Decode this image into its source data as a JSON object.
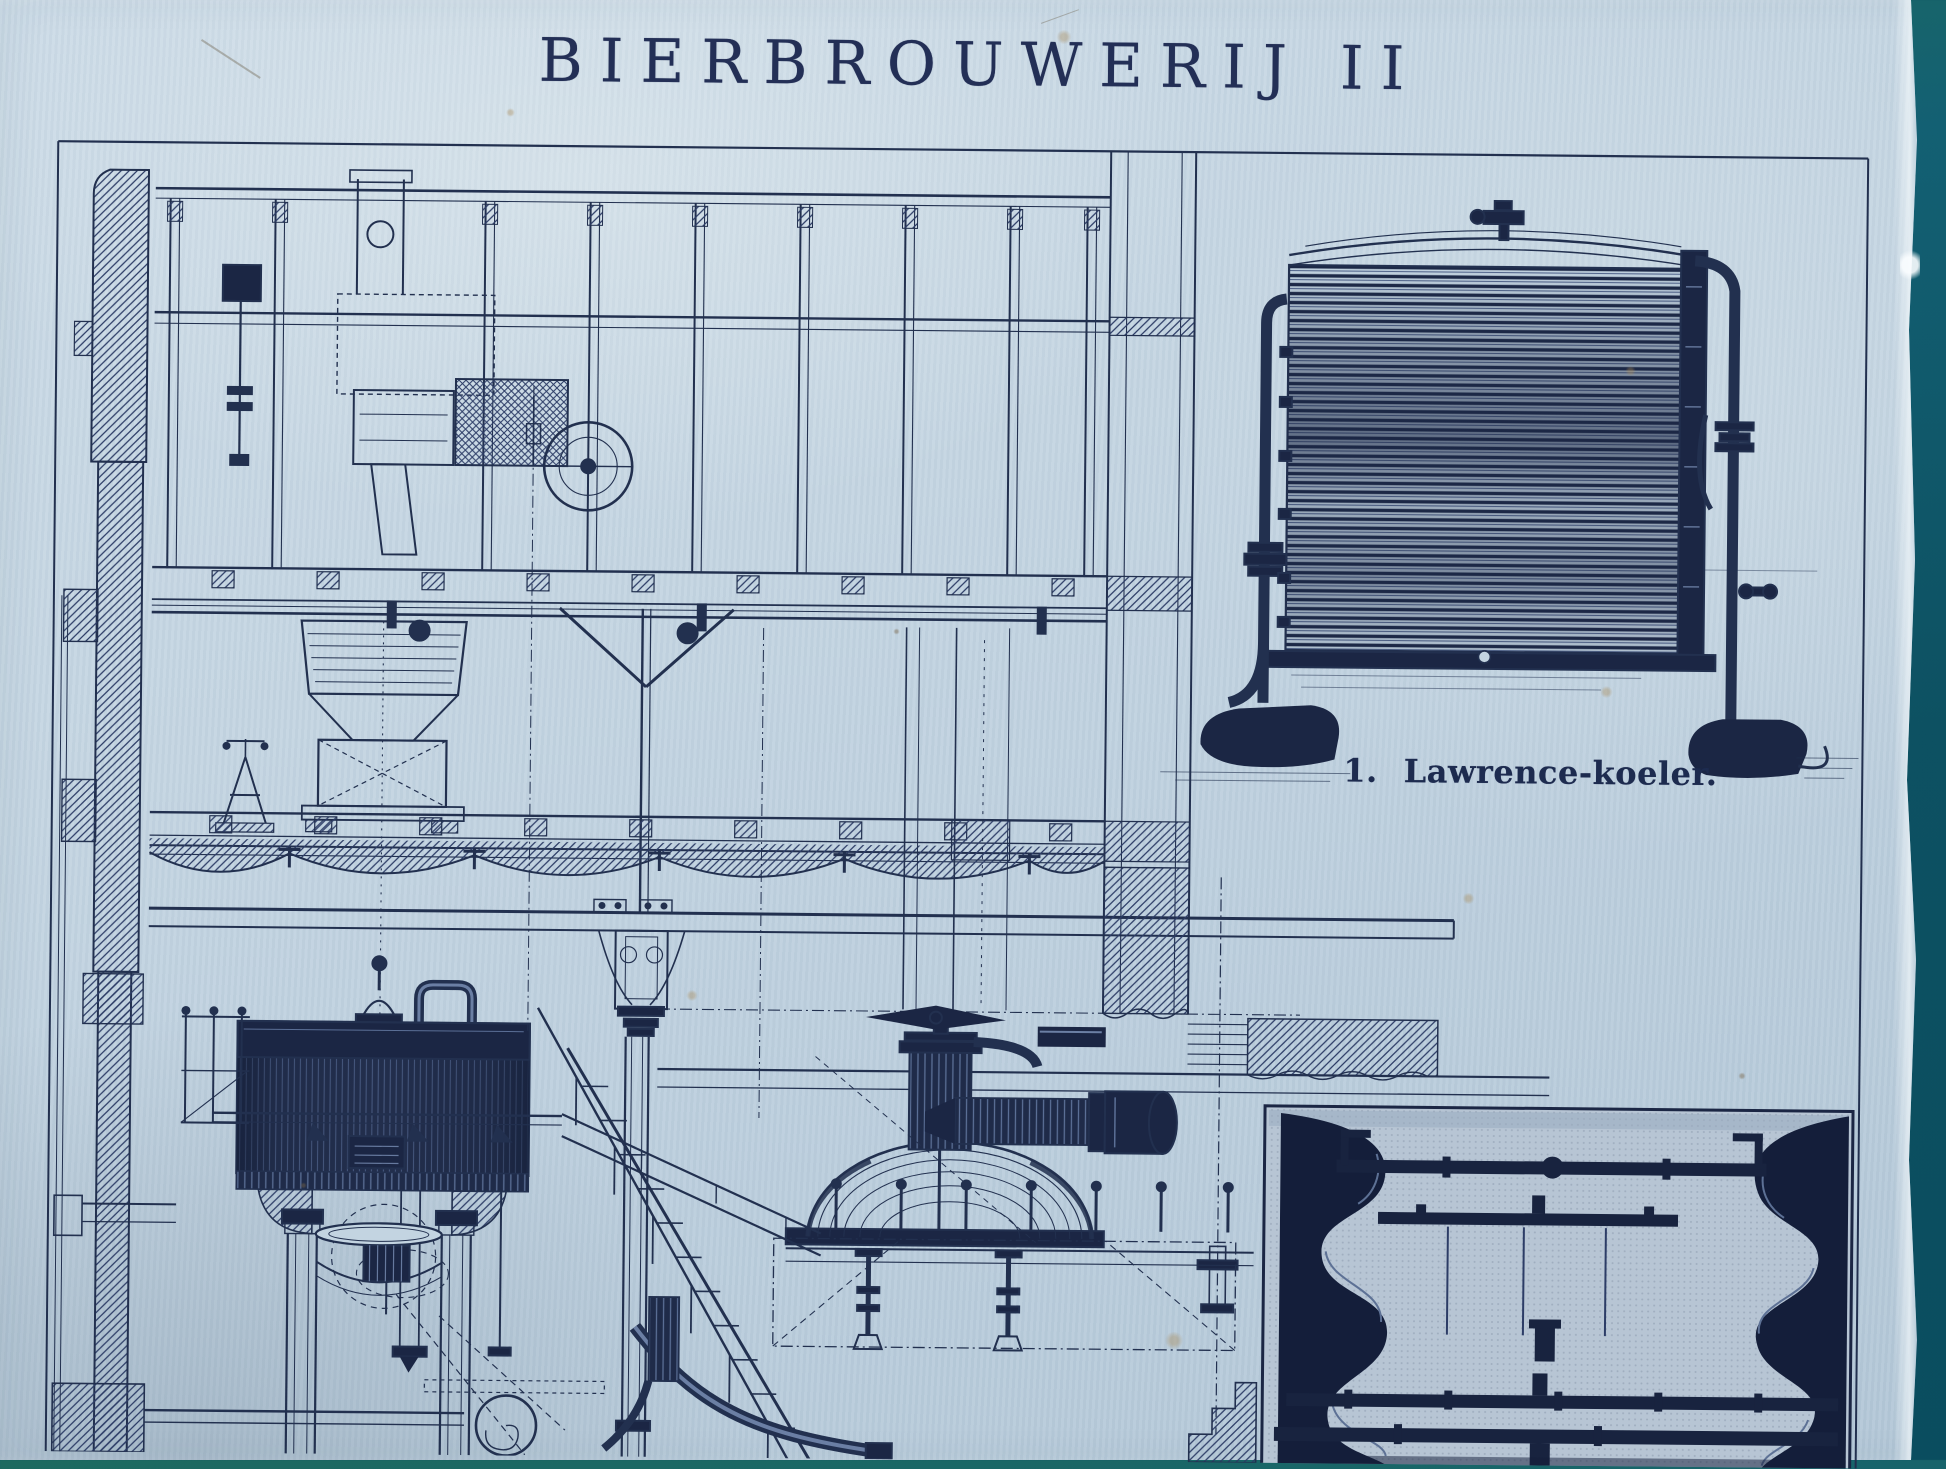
{
  "colors": {
    "backdrop": "#0d5162",
    "paper": "#c3d4e1",
    "ink": "#22304f",
    "ink_dark": "#1b2644",
    "figure_bg": "#b7c5d4"
  },
  "plate": {
    "title": "BIERBROUWERIJ II",
    "figure1": {
      "number": "1.",
      "caption": "Lawrence-koeler."
    }
  }
}
